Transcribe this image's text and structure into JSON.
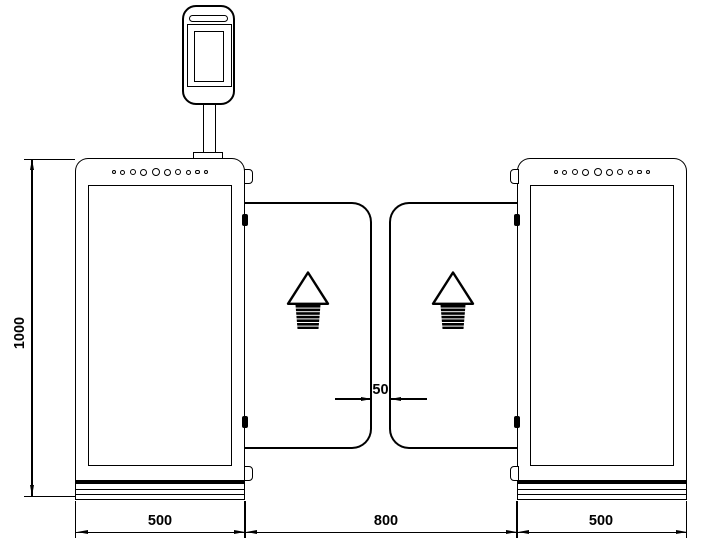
{
  "colors": {
    "line_color": "#000000",
    "background": "#ffffff"
  },
  "dimension_labels": {
    "overall_height": "1000",
    "left_cabinet_width": "500",
    "passage_width": "800",
    "right_cabinet_width": "500",
    "wing_gap": "50"
  },
  "icons": {
    "wing_direction": "up-arrow",
    "reader_device": "face-recognition-terminal",
    "cabinet_top": "speaker-hole-row"
  }
}
